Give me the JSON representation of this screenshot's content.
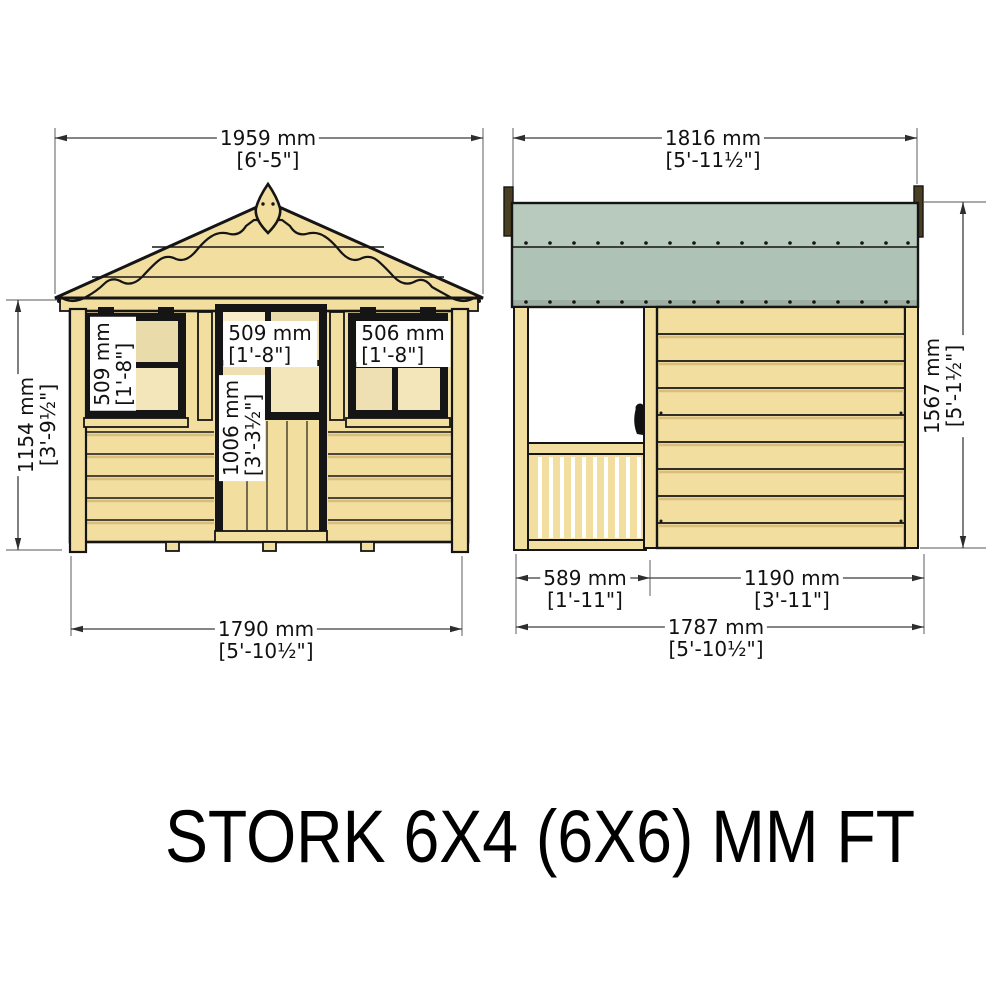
{
  "title": "STORK 6X4 (6X6) MM FT",
  "front": {
    "overall_width": {
      "mm": "1959 mm",
      "ft": "[6'-5\"]"
    },
    "wall_height": {
      "mm": "1154 mm",
      "ft": "[3'-9½\"]"
    },
    "left_window": {
      "mm": "509 mm",
      "ft": "[1'-8\"]"
    },
    "door_window": {
      "mm": "509 mm",
      "ft": "[1'-8\"]"
    },
    "right_window": {
      "mm": "506 mm",
      "ft": "[1'-8\"]"
    },
    "door_height": {
      "mm": "1006 mm",
      "ft": "[3'-3½\"]"
    },
    "base_width": {
      "mm": "1790 mm",
      "ft": "[5'-10½\"]"
    }
  },
  "side": {
    "overall_width": {
      "mm": "1816 mm",
      "ft": "[5'-11½\"]"
    },
    "overall_height": {
      "mm": "1567 mm",
      "ft": "[5'-1½\"]"
    },
    "porch_depth": {
      "mm": "589 mm",
      "ft": "[1'-11\"]"
    },
    "wall_width": {
      "mm": "1190 mm",
      "ft": "[3'-11\"]"
    },
    "base_width": {
      "mm": "1787 mm",
      "ft": "[5'-10½\"]"
    }
  },
  "colors": {
    "wood": "#f2dfa0",
    "wood_shade": "#d9bd7b",
    "pane_light": "#f7edc9",
    "pane_mid": "#eadbaa",
    "roof_green_top": "#b7cabd",
    "roof_green_low": "#aec3b5",
    "roof_green_strip": "#9cafa2",
    "trim_brown": "#4b3f22",
    "outline": "#151515",
    "dim_line": "#3c3c3c"
  }
}
